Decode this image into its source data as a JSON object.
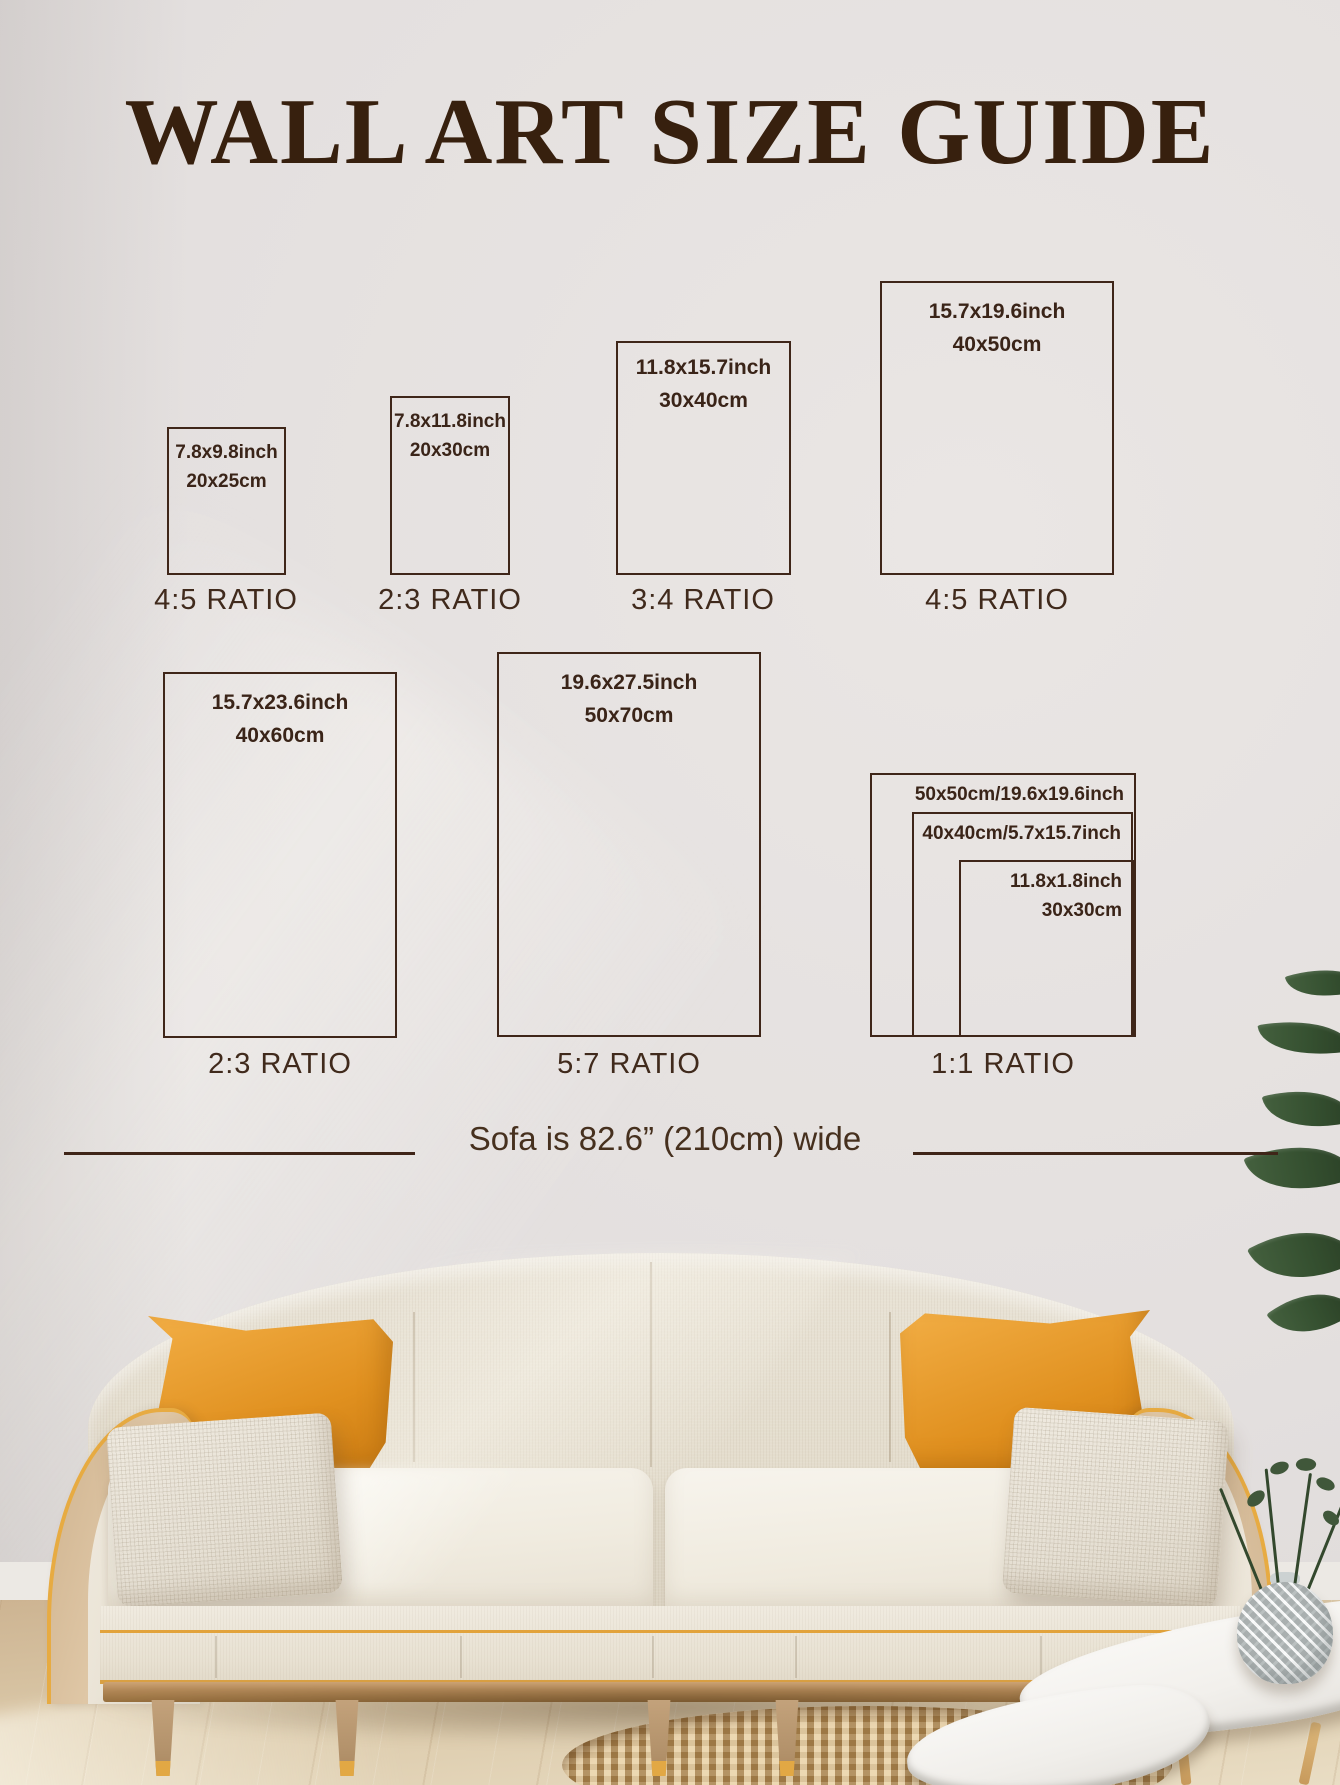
{
  "title": "WALL ART SIZE GUIDE",
  "frames": [
    {
      "size_inch": "7.8x9.8inch",
      "size_cm": "20x25cm",
      "ratio": "4:5 RATIO"
    },
    {
      "size_inch": "7.8x11.8inch",
      "size_cm": "20x30cm",
      "ratio": "2:3 RATIO"
    },
    {
      "size_inch": "11.8x15.7inch",
      "size_cm": "30x40cm",
      "ratio": "3:4 RATIO"
    },
    {
      "size_inch": "15.7x19.6inch",
      "size_cm": "40x50cm",
      "ratio": "4:5 RATIO"
    },
    {
      "size_inch": "15.7x23.6inch",
      "size_cm": "40x60cm",
      "ratio": "2:3 RATIO"
    },
    {
      "size_inch": "19.6x27.5inch",
      "size_cm": "50x70cm",
      "ratio": "5:7 RATIO"
    }
  ],
  "nested_frames": {
    "outer_label": "50x50cm/19.6x19.6inch",
    "middle_label": "40x40cm/5.7x15.7inch",
    "inner_line1": "11.8x1.8inch",
    "inner_line2": "30x30cm",
    "ratio": "1:1 RATIO"
  },
  "sofa_caption": "Sofa is 82.6” (210cm) wide",
  "colors": {
    "line_brown": "#3f2619",
    "title_brown": "#37200e",
    "accent_gold": "#e2a33c",
    "pillow_orange": "#e8991f",
    "wall_gray": "#e4e0df",
    "floor_wood": "#d9c3a2",
    "rug_tan": "#c49c63",
    "leaf_green": "#3c5435"
  }
}
